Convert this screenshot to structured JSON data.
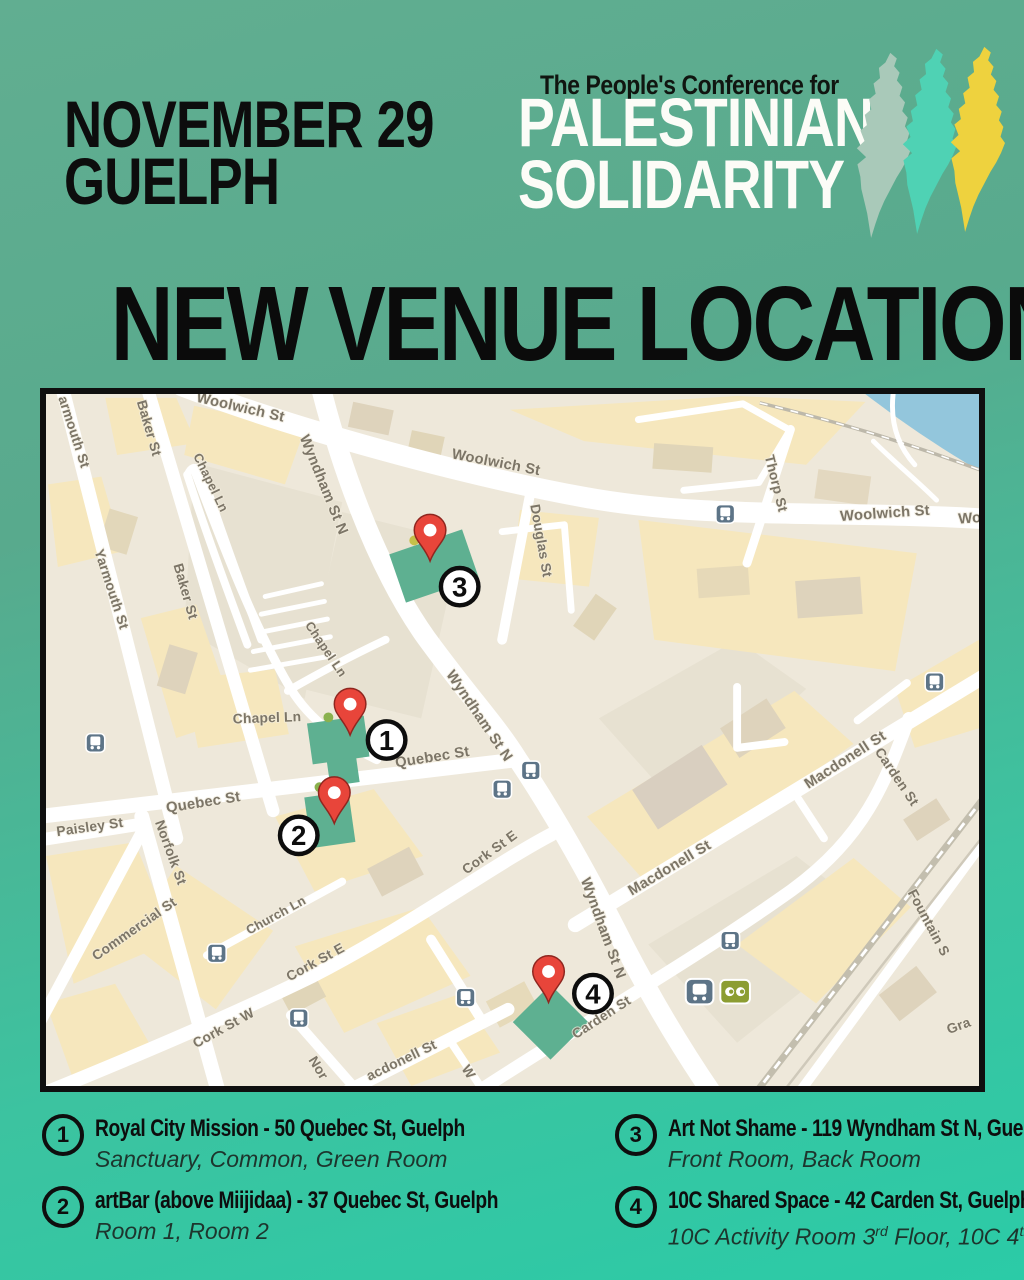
{
  "page": {
    "bg_top_color": "#61ae91",
    "bg_bottom_color": "#2bcba7",
    "accent_black": "#0d0d0d"
  },
  "header": {
    "date_line1": "NOVEMBER 29",
    "date_line2": "GUELPH"
  },
  "logo": {
    "tagline": "The People's Conference for",
    "title_line1": "PALESTINIAN",
    "title_line2": "SOLIDARITY",
    "shape_colors": [
      "#a9c9b9",
      "#4fd2b4",
      "#eed23e"
    ]
  },
  "headline": "NEW VENUE LOCATIONS",
  "venues": [
    {
      "number": "1",
      "title": "Royal City Mission - 50 Quebec St, Guelph",
      "rooms": "Sanctuary, Common, Green Room"
    },
    {
      "number": "2",
      "title": "artBar (above Miijidaa) - 37 Quebec St, Guelph",
      "rooms": "Room 1, Room 2"
    },
    {
      "number": "3",
      "title": "Art Not Shame - 119 Wyndham St N, Guelph",
      "rooms": "Front Room, Back Room"
    },
    {
      "number": "4",
      "title": "10C Shared Space - 42 Carden St, Guelph",
      "rooms_parts": {
        "p1": "10C Activity Room 3",
        "sup1": "rd",
        "p2": " Floor, 10C 4",
        "sup2": "th",
        "p3": " Floor"
      }
    }
  ],
  "map": {
    "colors": {
      "land": "#eee8da",
      "block_cream": "#f6e7bd",
      "road": "#ffffff",
      "water": "#93c6dc",
      "venue_highlight": "#5eb091",
      "pin_red": "#e8453a"
    },
    "street_labels": [
      {
        "t": "Woolwich St",
        "x": 196,
        "y": 18,
        "r": 13,
        "s": 15
      },
      {
        "t": "Woolwich St",
        "x": 455,
        "y": 74,
        "r": 11,
        "s": 15
      },
      {
        "t": "Woolwich St",
        "x": 850,
        "y": 126,
        "r": -4,
        "s": 15
      },
      {
        "t": "Wo",
        "x": 936,
        "y": 131,
        "r": -4,
        "s": 15
      },
      {
        "t": "Wyndham St N",
        "x": 277,
        "y": 94,
        "r": 68,
        "s": 15
      },
      {
        "t": "Wyndham St N",
        "x": 435,
        "y": 330,
        "r": 56,
        "s": 15
      },
      {
        "t": "Wyndham St N",
        "x": 560,
        "y": 545,
        "r": 70,
        "s": 15
      },
      {
        "t": "Douglas St",
        "x": 497,
        "y": 150,
        "r": 80,
        "s": 14
      },
      {
        "t": "Thorp St",
        "x": 735,
        "y": 92,
        "r": 76,
        "s": 14
      },
      {
        "t": "armouth St",
        "x": 24,
        "y": 40,
        "r": 72,
        "s": 14
      },
      {
        "t": "Yarmouth St",
        "x": 62,
        "y": 200,
        "r": 72,
        "s": 14
      },
      {
        "t": "Baker St",
        "x": 100,
        "y": 36,
        "r": 74,
        "s": 14
      },
      {
        "t": "Baker St",
        "x": 137,
        "y": 202,
        "r": 74,
        "s": 14
      },
      {
        "t": "Chapel Ln",
        "x": 163,
        "y": 92,
        "r": 64,
        "s": 13
      },
      {
        "t": "Chapel Ln",
        "x": 280,
        "y": 262,
        "r": 56,
        "s": 13
      },
      {
        "t": "Chapel Ln",
        "x": 224,
        "y": 334,
        "r": -2,
        "s": 14
      },
      {
        "t": "Quebec St",
        "x": 160,
        "y": 420,
        "r": -9,
        "s": 15
      },
      {
        "t": "Quebec St",
        "x": 392,
        "y": 374,
        "r": -9,
        "s": 15
      },
      {
        "t": "Paisley St",
        "x": 45,
        "y": 445,
        "r": -8,
        "s": 14
      },
      {
        "t": "Norfolk St",
        "x": 122,
        "y": 468,
        "r": 70,
        "s": 14
      },
      {
        "t": "Commercial St",
        "x": 92,
        "y": 548,
        "r": -35,
        "s": 14
      },
      {
        "t": "Church Ln",
        "x": 235,
        "y": 534,
        "r": -29,
        "s": 13
      },
      {
        "t": "Cork St E",
        "x": 452,
        "y": 470,
        "r": -36,
        "s": 14
      },
      {
        "t": "Cork St E",
        "x": 275,
        "y": 582,
        "r": -29,
        "s": 14
      },
      {
        "t": "Cork St W",
        "x": 182,
        "y": 649,
        "r": -29,
        "s": 14
      },
      {
        "t": "Macdonell St",
        "x": 812,
        "y": 376,
        "r": -33,
        "s": 15
      },
      {
        "t": "Macdonell St",
        "x": 634,
        "y": 486,
        "r": -31,
        "s": 15
      },
      {
        "t": "acdonell St",
        "x": 362,
        "y": 682,
        "r": -26,
        "s": 14
      },
      {
        "t": "Carden St",
        "x": 565,
        "y": 638,
        "r": -33,
        "s": 14
      },
      {
        "t": "Carden St",
        "x": 858,
        "y": 392,
        "r": 56,
        "s": 14
      },
      {
        "t": "Fountain S",
        "x": 890,
        "y": 540,
        "r": 62,
        "s": 14
      },
      {
        "t": "Gra",
        "x": 926,
        "y": 647,
        "r": -20,
        "s": 14
      },
      {
        "t": "Nor",
        "x": 272,
        "y": 688,
        "r": 58,
        "s": 14
      },
      {
        "t": "W",
        "x": 424,
        "y": 692,
        "r": 58,
        "s": 14
      }
    ],
    "transit_icons": [
      {
        "type": "bus",
        "x": 688,
        "y": 122
      },
      {
        "type": "bus",
        "x": 900,
        "y": 293
      },
      {
        "type": "bus",
        "x": 50,
        "y": 355
      },
      {
        "type": "bus",
        "x": 491,
        "y": 383
      },
      {
        "type": "bus",
        "x": 462,
        "y": 402
      },
      {
        "type": "bus",
        "x": 173,
        "y": 569
      },
      {
        "type": "bus",
        "x": 256,
        "y": 635
      },
      {
        "type": "bus",
        "x": 425,
        "y": 614
      },
      {
        "type": "bus",
        "x": 693,
        "y": 556
      },
      {
        "type": "train",
        "x": 662,
        "y": 608
      },
      {
        "type": "go",
        "x": 698,
        "y": 608
      }
    ],
    "poi_dots": [
      {
        "x": 373,
        "y": 149,
        "c": "#c5c04a"
      },
      {
        "x": 286,
        "y": 329,
        "c": "#8ab14e"
      },
      {
        "x": 277,
        "y": 400,
        "c": "#8ab14e"
      }
    ],
    "pins": [
      {
        "n": "1",
        "x": 308,
        "y": 347,
        "bx": 345,
        "by": 352
      },
      {
        "n": "2",
        "x": 292,
        "y": 437,
        "bx": 256,
        "by": 449
      },
      {
        "n": "3",
        "x": 389,
        "y": 170,
        "bx": 419,
        "by": 196
      },
      {
        "n": "4",
        "x": 509,
        "y": 619,
        "bx": 554,
        "by": 610
      }
    ]
  }
}
